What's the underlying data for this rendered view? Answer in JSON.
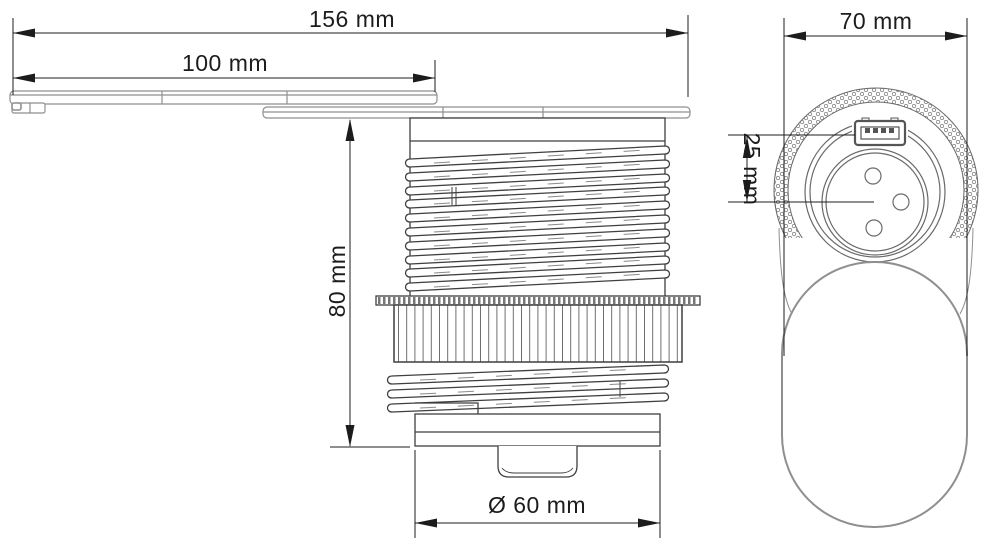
{
  "colors": {
    "outline": "#3f3f3f",
    "soft_outline": "#8f8f8f",
    "detail": "#6a6a6a",
    "dimension": "#1c1c1c",
    "background": "#ffffff"
  },
  "drawing": {
    "type": "technical-drawing",
    "subject": "pop-up-desk-power-socket-with-usb",
    "side_view": {
      "dimensions": {
        "overall_length": "156 mm",
        "lid_length": "100 mm",
        "body_height": "80 mm",
        "body_diameter": "Ø 60 mm"
      }
    },
    "top_view": {
      "dimensions": {
        "overall_width": "70 mm",
        "usb_to_socket_center": "25 mm"
      }
    }
  }
}
